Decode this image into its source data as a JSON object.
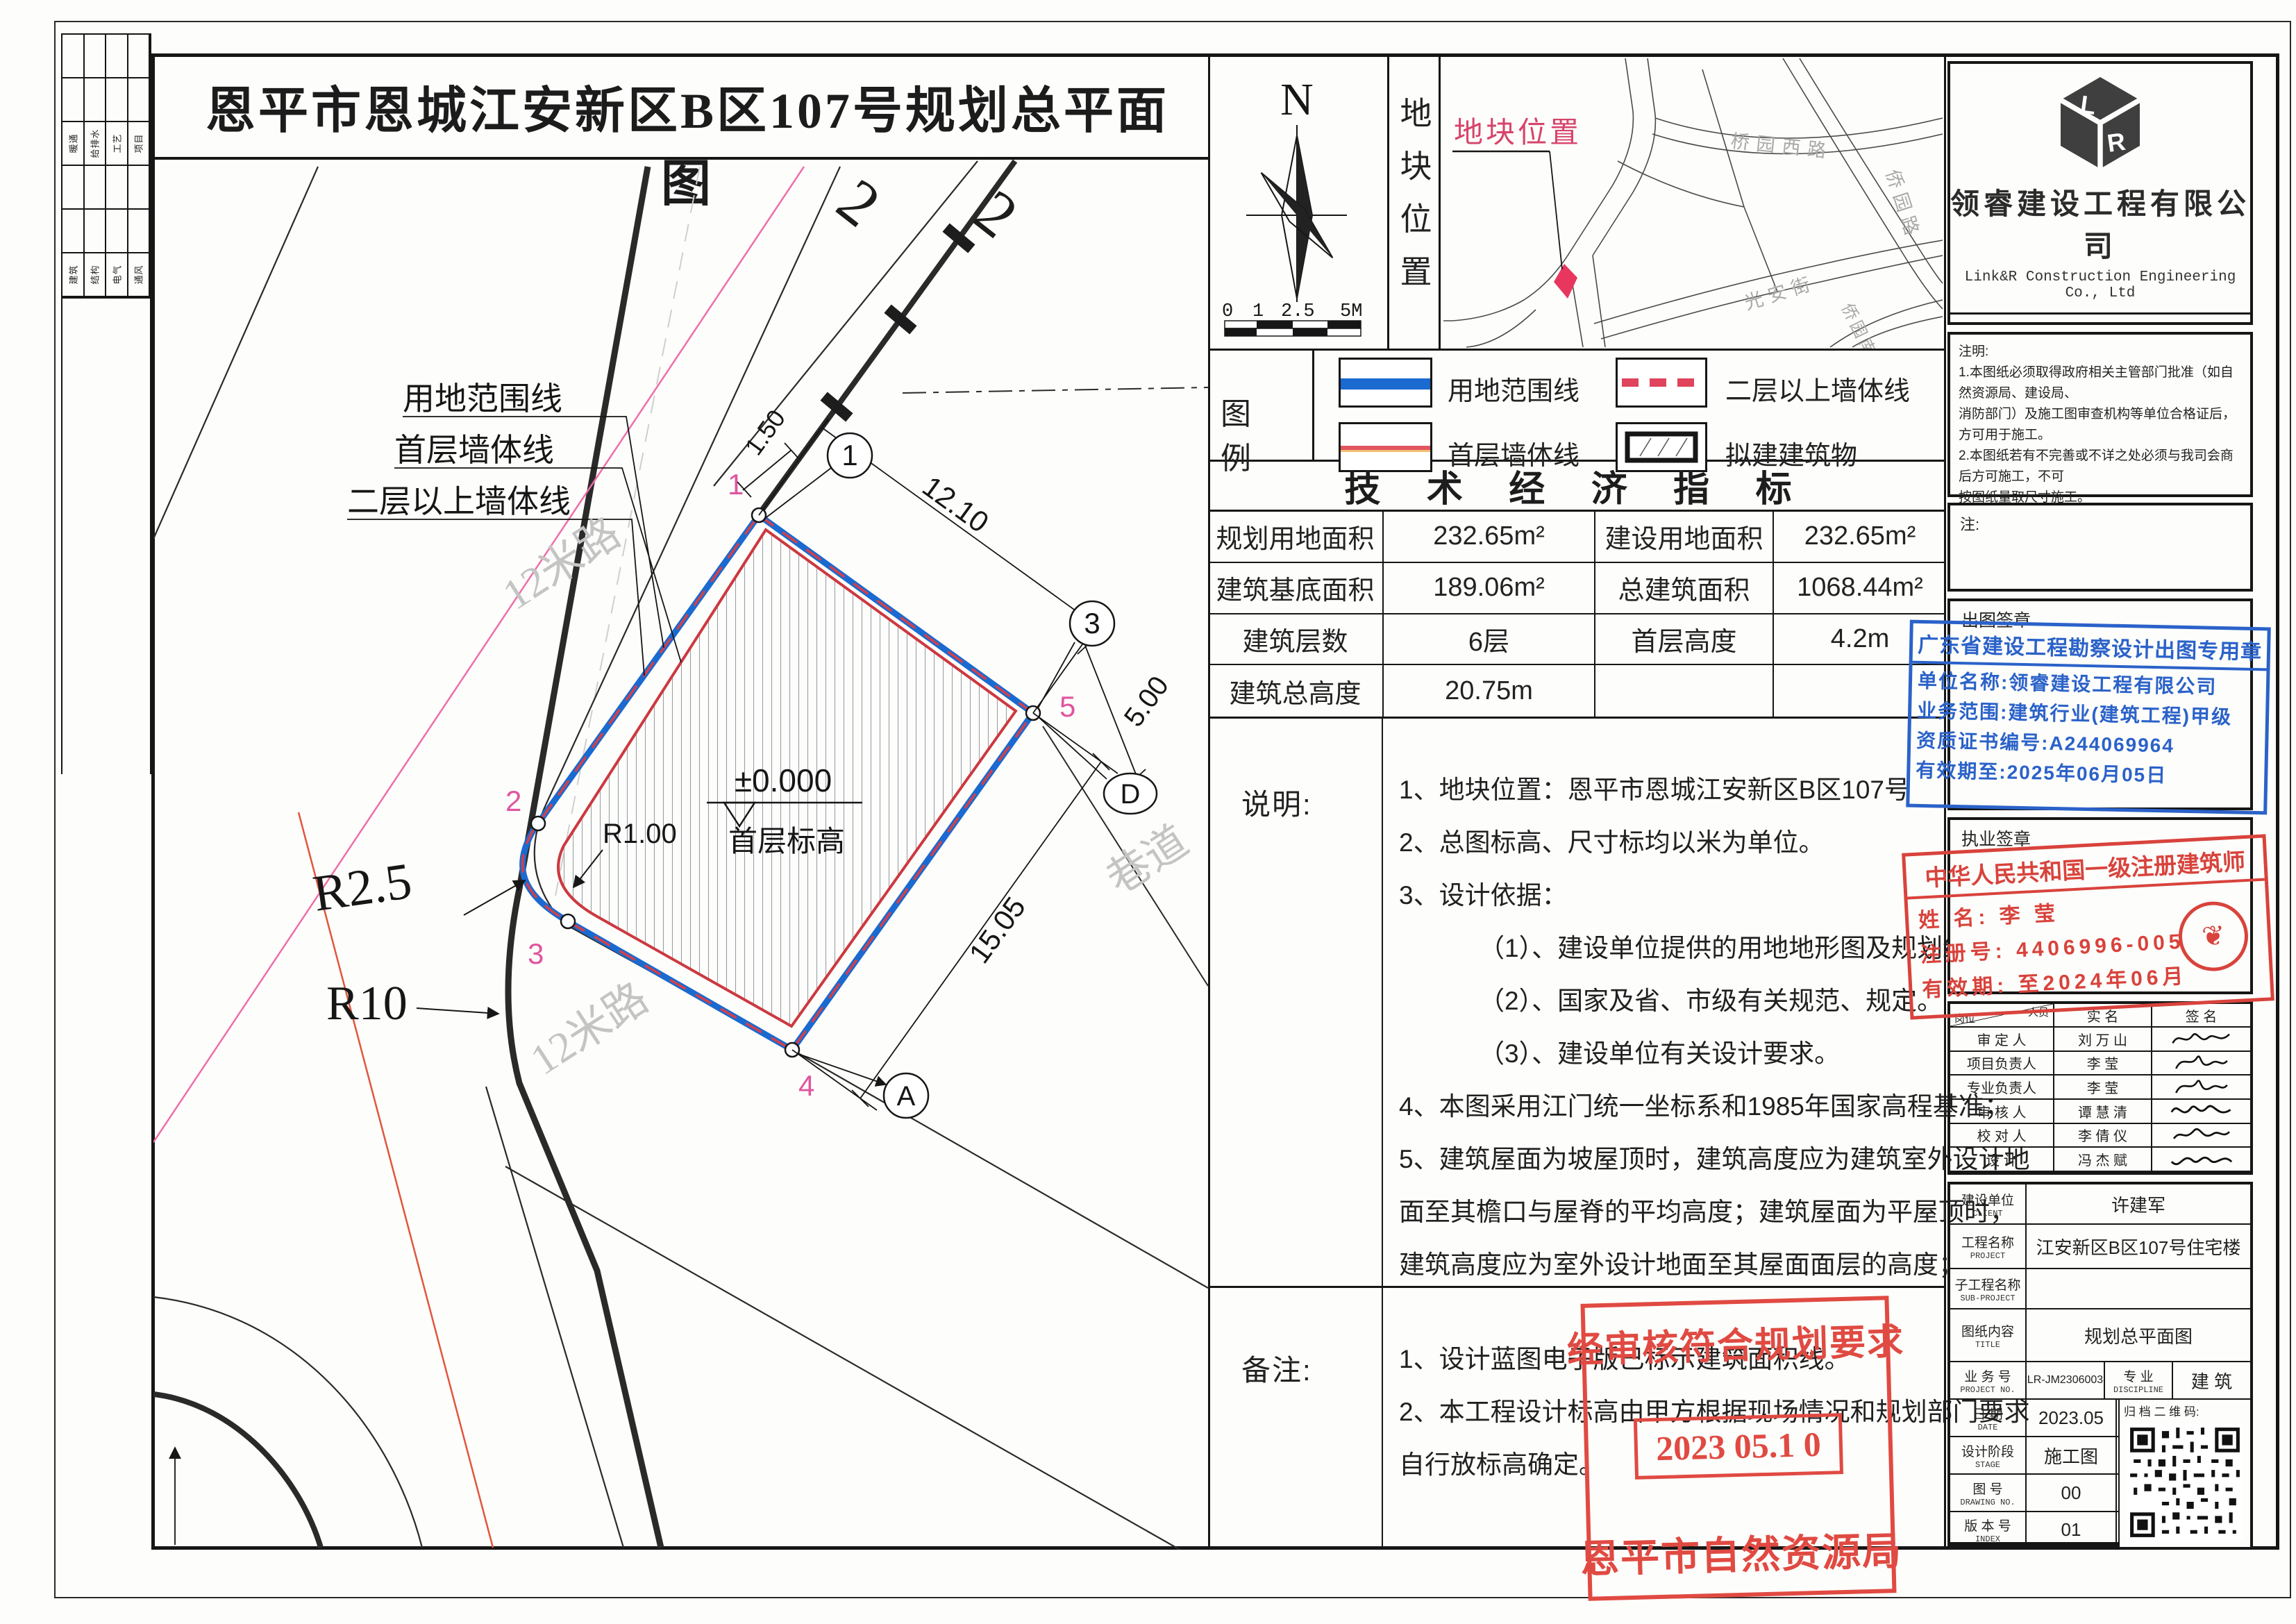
{
  "sheet": {
    "title": "恩平市恩城江安新区B区107号规划总平面图"
  },
  "signbar": {
    "row3": [
      "暖通",
      "给排水",
      "工艺",
      "项目"
    ],
    "row6": [
      "建筑",
      "结构",
      "电气",
      "通风"
    ]
  },
  "plan": {
    "callout_site": "用地范围线",
    "callout_floor1": "首层墙体线",
    "callout_floor2": "二层以上墙体线",
    "road12_upper": "12米路",
    "road12_lower": "12米路",
    "lane": "巷道",
    "dim_1210": "12.10",
    "dim_1505": "15.05",
    "dim_500": "5.00",
    "dim_150": "1.50",
    "r100": "R1.00",
    "r25": "R2.5",
    "r10": "R10",
    "level_value": "±0.000",
    "level_label": "首层标高",
    "p1": "1",
    "p2": "2",
    "p3": "3",
    "p4": "4",
    "p5": "5",
    "grid1": "1",
    "grid3": "3",
    "gridD": "D",
    "gridA": "A",
    "num2a": "2",
    "num2b": "2"
  },
  "north": {
    "n": "N",
    "s0": "0",
    "s1": "1",
    "s2": "2.5",
    "s3": "5M"
  },
  "location": {
    "strip": "地块位置",
    "callout": "地块位置",
    "road1": "桥园西路",
    "road2": "侨园路",
    "road3": "光安街",
    "road4": "侨园南路"
  },
  "legend": {
    "title": "图 例",
    "item1": "用地范围线",
    "item2": "二层以上墙体线",
    "item3": "首层墙体线",
    "item4": "拟建建筑物"
  },
  "tech": {
    "title": "技 术 经 济 指 标",
    "rows": [
      {
        "l1": "规划用地面积",
        "v1": "232.65m²",
        "l2": "建设用地面积",
        "v2": "232.65m²"
      },
      {
        "l1": "建筑基底面积",
        "v1": "189.06m²",
        "l2": "总建筑面积",
        "v2": "1068.44m²"
      },
      {
        "l1": "建筑层数",
        "v1": "6层",
        "l2": "首层高度",
        "v2": "4.2m"
      },
      {
        "l1": "建筑总高度",
        "v1": "20.75m",
        "l2": "",
        "v2": ""
      }
    ]
  },
  "notes": {
    "label": "说明:",
    "lines": [
      "1、地块位置：恩平市恩城江安新区B区107号",
      "2、总图标高、尺寸标均以米为单位。",
      "3、设计依据：",
      "（1）、建设单位提供的用地地形图及规划红线图。",
      "（2）、国家及省、市级有关规范、规定。",
      "（3）、建设单位有关设计要求。",
      "4、本图采用江门统一坐标系和1985年国家高程基准；",
      "5、建筑屋面为坡屋顶时，建筑高度应为建筑室外设计地",
      "面至其檐口与屋脊的平均高度；建筑屋面为平屋顶时，",
      "建筑高度应为室外设计地面至其屋面面层的高度；"
    ]
  },
  "remarks": {
    "label": "备注:",
    "lines": [
      "1、设计蓝图电子版已标示建筑面积线。",
      "2、本工程设计标高由甲方根据现场情况和规划部门要求",
      "自行放标高确定。"
    ]
  },
  "approval": {
    "line1": "经审核符合规划要求",
    "date": "2023 05.1 0",
    "org": "恩平市自然资源局"
  },
  "company": {
    "logo": "LR",
    "name": "领睿建设工程有限公司",
    "name_en": "Link&R Construction Engineering Co., Ltd",
    "cert_label": "建筑工程设计证书号:",
    "cert_no": "A244069964"
  },
  "instructions": {
    "label": "注明:",
    "lines": [
      "1.本图纸必须取得政府相关主管部门批准（如自然资源局、建设局、",
      "消防部门）及施工图审查机构等单位合格证后，方可用于施工。",
      "2.本图纸若有不完善或不详之处必须与我司会商后方可施工，不可",
      "按图纸量取尺寸施工。",
      "3.本图纸未经同意不得复制使用、泄露、散布。",
      "4.本图纸须加盖出图签章、执业签章及二维码,否则一律无效。"
    ]
  },
  "notebox": {
    "label": "注:"
  },
  "chop_out": {
    "label": "出图签章",
    "title": "广东省建设工程勘察设计出图专用章",
    "l1": "单位名称:领睿建设工程有限公司",
    "l2": "业务范围:建筑行业(建筑工程)甲级",
    "l3": "资质证书编号:A244069964",
    "l4": "有效期至:2025年06月05日"
  },
  "chop_lic": {
    "label": "执业签章",
    "title": "中华人民共和国一级注册建筑师",
    "l1": "姓 名: 李 莹",
    "l2": "注册号: 4406996-005",
    "l3": "有效期: 至2024年06月"
  },
  "personnel": {
    "h_person": "人员",
    "h_role": "岗位",
    "h_name": "实  名",
    "h_sign": "签  名",
    "rows": [
      {
        "role": "审 定 人",
        "name": "刘 万 山"
      },
      {
        "role": "项目负责人",
        "name": "李  莹"
      },
      {
        "role": "专业负责人",
        "name": "李  莹"
      },
      {
        "role": "审 核 人",
        "name": "谭 慧 清"
      },
      {
        "role": "校 对 人",
        "name": "李 倩 仪"
      },
      {
        "role": "设  计",
        "name": "冯 杰 赋"
      }
    ]
  },
  "titleblock": {
    "client_l": "建设单位",
    "client_e": "CLIENT",
    "client_v": "许建军",
    "project_l": "工程名称",
    "project_e": "PROJECT",
    "project_v": "江安新区B区107号住宅楼",
    "sub_l": "子工程名称",
    "sub_e": "SUB-PROJECT",
    "sub_v": "",
    "title_l": "图纸内容",
    "title_e": "TITLE",
    "title_v": "规划总平面图",
    "no_l": "业 务 号",
    "no_e": "PROJECT NO.",
    "no_v": "LR-JM2306003",
    "disc_l": "专 业",
    "disc_e": "DISCIPLINE",
    "disc_v": "建 筑",
    "date_l": "日 期",
    "date_e": "DATE",
    "date_v": "2023.05",
    "qr_l": "归 档 二 维 码:",
    "stage_l": "设计阶段",
    "stage_e": "STAGE",
    "stage_v": "施工图",
    "dwg_l": "图 号",
    "dwg_e": "DRAWING NO.",
    "dwg_v": "00",
    "index_l": "版 本 号",
    "index_e": "INDEX",
    "index_v": "01"
  }
}
